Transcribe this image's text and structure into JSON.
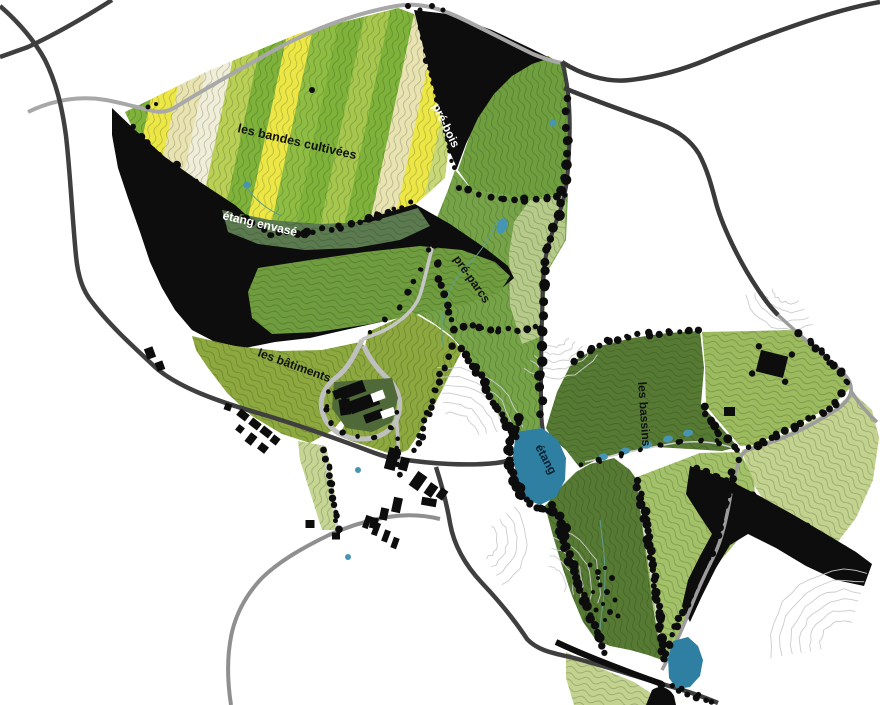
{
  "map": {
    "type": "landscape-site-plan",
    "region_labels": {
      "bandes_cultivees": "les bandes cultivées",
      "pre_bois": "pré-bois",
      "etang_envase": "étang envasé",
      "pre_parcs": "pré-parcs",
      "batiments": "les bâtiments",
      "bassins": "les bassins",
      "etang": "étang"
    },
    "palette": {
      "stripe_green": "#7eb23a",
      "stripe_yellow": "#ece746",
      "stripe_cream": "#e9e3b2",
      "meadow_green": "#76a348",
      "meadow_dark_green": "#567a33",
      "meadow_light_green": "#a3c168",
      "pale_green": "#c3d28e",
      "sage_green": "#b6ca8a",
      "olive_green": "#8ca83e",
      "silt_band_green": "#5c7a50",
      "forest_black": "#0d0d0d",
      "water_blue": "#2e7fa2",
      "basin_blue": "#4795b5",
      "road_dark": "#3f3f3f",
      "road_gray": "#9d9d9d",
      "contour_gray": "#cccccc"
    }
  }
}
